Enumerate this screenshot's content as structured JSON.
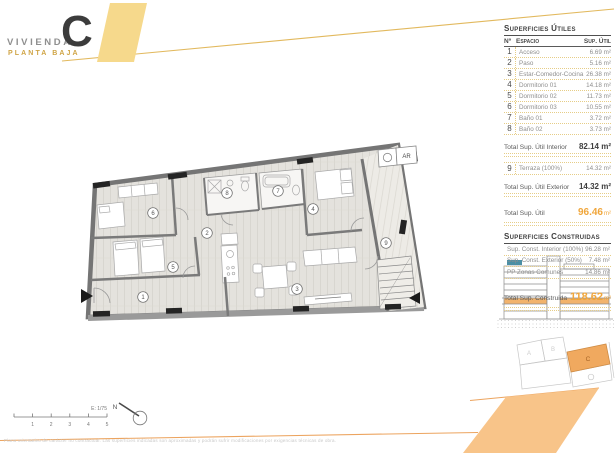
{
  "header": {
    "brand": "VIVIENDA",
    "unit": "C",
    "floor": "PLANTA BAJA"
  },
  "useful": {
    "title": "Superficies Útiles",
    "col_num": "Nº",
    "col_space": "Espacio",
    "col_area": "Sup. Útil",
    "rows": [
      {
        "num": "1",
        "space": "Acceso",
        "area": "6.69 m²"
      },
      {
        "num": "2",
        "space": "Paso",
        "area": "5.16 m²"
      },
      {
        "num": "3",
        "space": "Estar-Comedor-Cocina",
        "area": "26.38 m²"
      },
      {
        "num": "4",
        "space": "Dormitorio 01",
        "area": "14.18 m²"
      },
      {
        "num": "5",
        "space": "Dormitorio 02",
        "area": "11.73 m²"
      },
      {
        "num": "6",
        "space": "Dormitorio 03",
        "area": "10.55 m²"
      },
      {
        "num": "7",
        "space": "Baño 01",
        "area": "3.72 m²"
      },
      {
        "num": "8",
        "space": "Baño 02",
        "area": "3.73 m²"
      }
    ],
    "total_interior_label": "Total Sup. Útil Interior",
    "total_interior_value": "82.14 m²",
    "exterior_row": {
      "num": "9",
      "space": "Terraza (100%)",
      "area": "14.32 m²"
    },
    "total_exterior_label": "Total Sup. Útil Exterior",
    "total_exterior_value": "14.32 m²",
    "total_label": "Total Sup. Útil",
    "total_value": "96.46",
    "total_unit": "m²"
  },
  "built": {
    "title": "Superficies Construidas",
    "rows": [
      {
        "label": "Sup. Const. Interior (100%)",
        "value": "96.28 m²"
      },
      {
        "label": "Sup. Const. Exterior (50%)",
        "value": "7.48 m²"
      },
      {
        "label": "PP Zonas Comunes",
        "value": "14.86 m²"
      }
    ],
    "total_label": "Total Sup. Construida",
    "total_value": "118.62",
    "total_unit": "m²"
  },
  "plan": {
    "rooms": [
      {
        "num": "1"
      },
      {
        "num": "2"
      },
      {
        "num": "3"
      },
      {
        "num": "4"
      },
      {
        "num": "5"
      },
      {
        "num": "6"
      },
      {
        "num": "7"
      },
      {
        "num": "8"
      },
      {
        "num": "9"
      }
    ],
    "ar_label": "AR",
    "scale_label": "E: 1/75",
    "scale_ticks": [
      "1",
      "2",
      "3",
      "4",
      "5"
    ],
    "north_label": "N"
  },
  "key_plan": {
    "unit_a": "A",
    "unit_b": "B",
    "unit_c": "C",
    "highlighted": "C"
  },
  "footer": {
    "disclaimer": "Plano orientativo de carácter no contractual. Las superficies indicadas son aproximadas y podrán sufrir modificaciones por exigencias técnicas de obra."
  },
  "colors": {
    "accent_yellow": "#f6d98c",
    "accent_orange": "#f8c489",
    "totals_orange": "#f0a63b",
    "unit_highlight": "#f0a95f",
    "elevation_highlight": "#f2b36c",
    "elevation_blue": "#4b8fa5",
    "plan_wall": "#757575"
  }
}
